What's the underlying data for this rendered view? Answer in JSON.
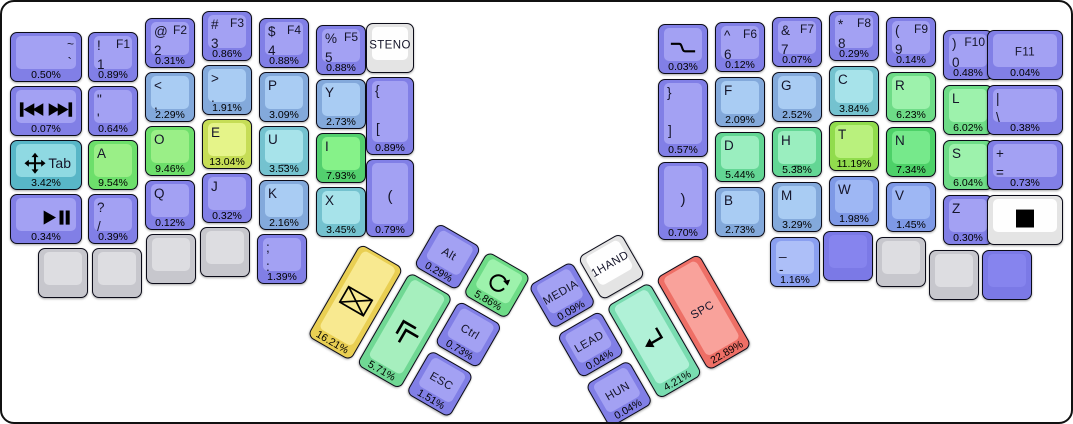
{
  "board": {
    "background": "#ffffff",
    "frame_border": "#111111"
  },
  "colors": {
    "purple": {
      "base": "#817fe6",
      "top": "#a3a1f3"
    },
    "purpleblank": {
      "base": "#7b79e6",
      "top": "#8684ee"
    },
    "lightblue": {
      "base": "#83a9db",
      "top": "#a9ccf3"
    },
    "blue2": {
      "base": "#7e99e6",
      "top": "#9eb7f4"
    },
    "periwinkle": {
      "base": "#8a9ff0",
      "top": "#adbff8"
    },
    "teal": {
      "base": "#58b6c7",
      "top": "#8fd9e2"
    },
    "tealight": {
      "base": "#74c2cf",
      "top": "#a7e3ea"
    },
    "mint": {
      "base": "#63d694",
      "top": "#9aeebf"
    },
    "mint2": {
      "base": "#79dcb0",
      "top": "#b0f1d7"
    },
    "mintgreen": {
      "base": "#70d894",
      "top": "#a6efbe"
    },
    "green": {
      "base": "#6ddf6b",
      "top": "#9aef87"
    },
    "brightgreen": {
      "base": "#53d06e",
      "top": "#86f289"
    },
    "green2": {
      "base": "#6edc87",
      "top": "#9df2ac"
    },
    "greensat": {
      "base": "#4dd168",
      "top": "#76e98b"
    },
    "yellowgreen": {
      "base": "#c6dd56",
      "top": "#e5f489"
    },
    "greenyellow": {
      "base": "#91dc4d",
      "top": "#b9f17d"
    },
    "yellow": {
      "base": "#e9cf53",
      "top": "#f8e990"
    },
    "salmon": {
      "base": "#ee6f66",
      "top": "#f9a29b"
    },
    "white": {
      "base": "#e4e4e4",
      "top": "#fefefe"
    },
    "grey": {
      "base": "#c7c7cd",
      "top": "#dddde1"
    }
  },
  "left_main": [
    {
      "name": "key-grave",
      "x": 10,
      "y": 32,
      "w": 72,
      "color": "purple",
      "labels": [
        [
          "~",
          "tr"
        ],
        [
          "`",
          "r2"
        ]
      ],
      "pct": "0.50%"
    },
    {
      "name": "key-1",
      "x": 88,
      "y": 32,
      "color": "purple",
      "labels": [
        [
          "!",
          "tl"
        ],
        [
          "F1",
          "tr"
        ],
        [
          "1",
          "l2"
        ]
      ],
      "pct": "0.89%"
    },
    {
      "name": "key-2",
      "x": 145,
      "y": 18,
      "color": "purple",
      "labels": [
        [
          "@",
          "tl"
        ],
        [
          "F2",
          "tr"
        ],
        [
          "2",
          "l2"
        ]
      ],
      "pct": "0.31%"
    },
    {
      "name": "key-3",
      "x": 202,
      "y": 11,
      "color": "purple",
      "labels": [
        [
          "#",
          "tl"
        ],
        [
          "F3",
          "tr"
        ],
        [
          "3",
          "l2"
        ]
      ],
      "pct": "0.86%"
    },
    {
      "name": "key-4",
      "x": 259,
      "y": 18,
      "color": "purple",
      "labels": [
        [
          "$",
          "tl"
        ],
        [
          "F4",
          "tr"
        ],
        [
          "4",
          "l2"
        ]
      ],
      "pct": "0.88%"
    },
    {
      "name": "key-5",
      "x": 316,
      "y": 25,
      "color": "purple",
      "labels": [
        [
          "%",
          "tl"
        ],
        [
          "F5",
          "tr"
        ],
        [
          "5",
          "l2"
        ]
      ],
      "pct": "0.88%"
    },
    {
      "name": "key-steno",
      "x": 366,
      "y": 23,
      "w": 48,
      "color": "white",
      "labels": [
        [
          "STENO",
          "c"
        ]
      ]
    },
    {
      "name": "key-media-tracks",
      "x": 10,
      "y": 86,
      "w": 72,
      "color": "purple",
      "icon": "prev-next-track-icon",
      "pct": "0.07%"
    },
    {
      "name": "key-quote",
      "x": 88,
      "y": 86,
      "color": "purple",
      "labels": [
        [
          "\"",
          "tl"
        ],
        [
          "'",
          "l2"
        ]
      ],
      "pct": "0.64%"
    },
    {
      "name": "key-comma",
      "x": 145,
      "y": 72,
      "color": "lightblue",
      "labels": [
        [
          "<",
          "tl"
        ],
        [
          ",",
          "l2"
        ]
      ],
      "pct": "2.29%"
    },
    {
      "name": "key-period",
      "x": 202,
      "y": 65,
      "color": "lightblue",
      "labels": [
        [
          ">",
          "tl"
        ],
        [
          ".",
          "l2"
        ]
      ],
      "pct": "1.91%"
    },
    {
      "name": "key-p",
      "x": 259,
      "y": 72,
      "color": "lightblue",
      "labels": [
        [
          "P",
          "tl"
        ]
      ],
      "pct": "3.09%"
    },
    {
      "name": "key-y",
      "x": 316,
      "y": 79,
      "color": "lightblue",
      "labels": [
        [
          "Y",
          "tl"
        ]
      ],
      "pct": "2.73%"
    },
    {
      "name": "key-lbracket",
      "x": 366,
      "y": 77,
      "w": 48,
      "h": 78,
      "color": "purple",
      "labels": [
        [
          "{",
          "tl"
        ],
        [
          "[",
          "l2t"
        ]
      ],
      "pct": "0.89%"
    },
    {
      "name": "key-tab",
      "x": 10,
      "y": 140,
      "w": 72,
      "color": "teal",
      "icon": "move-icon",
      "ipos": "l",
      "labels": [
        [
          "Tab",
          "r"
        ]
      ],
      "pct": "3.42%"
    },
    {
      "name": "key-a",
      "x": 88,
      "y": 140,
      "color": "green",
      "labels": [
        [
          "A",
          "tl"
        ]
      ],
      "pct": "9.54%"
    },
    {
      "name": "key-o",
      "x": 145,
      "y": 126,
      "color": "green",
      "labels": [
        [
          "O",
          "tl"
        ]
      ],
      "pct": "9.46%"
    },
    {
      "name": "key-e",
      "x": 202,
      "y": 119,
      "color": "yellowgreen",
      "labels": [
        [
          "E",
          "tl"
        ]
      ],
      "pct": "13.04%"
    },
    {
      "name": "key-u",
      "x": 259,
      "y": 126,
      "color": "tealight",
      "labels": [
        [
          "U",
          "tl"
        ],
        [
          "_",
          "sub"
        ]
      ],
      "pct": "3.53%"
    },
    {
      "name": "key-i",
      "x": 316,
      "y": 133,
      "color": "brightgreen",
      "labels": [
        [
          "I",
          "tl"
        ]
      ],
      "pct": "7.93%"
    },
    {
      "name": "key-lparen",
      "x": 366,
      "y": 159,
      "w": 48,
      "h": 78,
      "color": "purple",
      "labels": [
        [
          "(",
          "cb"
        ]
      ],
      "pct": "0.79%"
    },
    {
      "name": "key-play-pause",
      "x": 10,
      "y": 194,
      "w": 72,
      "color": "purple",
      "icon": "play-pause-icon",
      "ipos": "r",
      "pct": "0.34%"
    },
    {
      "name": "key-question",
      "x": 88,
      "y": 194,
      "color": "purple",
      "labels": [
        [
          "?",
          "tl"
        ],
        [
          "/",
          "l2"
        ]
      ],
      "pct": "0.39%"
    },
    {
      "name": "key-q",
      "x": 145,
      "y": 180,
      "color": "purple",
      "labels": [
        [
          "Q",
          "tl"
        ]
      ],
      "pct": "0.12%"
    },
    {
      "name": "key-j",
      "x": 202,
      "y": 173,
      "color": "purple",
      "labels": [
        [
          "J",
          "tl"
        ]
      ],
      "pct": "0.32%"
    },
    {
      "name": "key-k",
      "x": 259,
      "y": 180,
      "color": "lightblue",
      "labels": [
        [
          "K",
          "tl"
        ]
      ],
      "pct": "2.16%"
    },
    {
      "name": "key-x",
      "x": 316,
      "y": 187,
      "color": "tealight",
      "labels": [
        [
          "X",
          "tl"
        ]
      ],
      "pct": "3.45%"
    },
    {
      "name": "key-blank",
      "x": 38,
      "y": 248,
      "color": "grey"
    },
    {
      "name": "key-blank",
      "x": 92,
      "y": 248,
      "color": "grey"
    },
    {
      "name": "key-blank",
      "x": 146,
      "y": 234,
      "color": "grey"
    },
    {
      "name": "key-blank",
      "x": 200,
      "y": 227,
      "color": "grey"
    },
    {
      "name": "key-semicolon",
      "x": 257,
      "y": 234,
      "color": "purple",
      "labels": [
        [
          ";",
          "tl"
        ],
        [
          ":",
          "l2"
        ]
      ],
      "pct": "1.39%"
    }
  ],
  "right_main": [
    {
      "name": "key-wave",
      "x": 658,
      "y": 24,
      "color": "purple",
      "icon": "wave-icon",
      "pct": "0.03%"
    },
    {
      "name": "key-6",
      "x": 715,
      "y": 22,
      "color": "purple",
      "labels": [
        [
          "^",
          "tl"
        ],
        [
          "F6",
          "tr"
        ],
        [
          "6",
          "l2"
        ]
      ],
      "pct": "0.12%"
    },
    {
      "name": "key-7",
      "x": 772,
      "y": 17,
      "color": "purple",
      "labels": [
        [
          "&",
          "tl"
        ],
        [
          "F7",
          "tr"
        ],
        [
          "7",
          "l2"
        ]
      ],
      "pct": "0.07%"
    },
    {
      "name": "key-8",
      "x": 829,
      "y": 11,
      "color": "purple",
      "labels": [
        [
          "*",
          "tl"
        ],
        [
          "F8",
          "tr"
        ],
        [
          "8",
          "l2"
        ]
      ],
      "pct": "0.29%"
    },
    {
      "name": "key-9",
      "x": 886,
      "y": 17,
      "color": "purple",
      "labels": [
        [
          "(",
          "tl"
        ],
        [
          "F9",
          "tr"
        ],
        [
          "9",
          "l2"
        ]
      ],
      "pct": "0.14%"
    },
    {
      "name": "key-0",
      "x": 943,
      "y": 30,
      "color": "purple",
      "labels": [
        [
          ")",
          "tl"
        ],
        [
          "F10",
          "tr"
        ],
        [
          "0",
          "l2"
        ]
      ],
      "pct": "0.48%"
    },
    {
      "name": "key-f11",
      "x": 987,
      "y": 30,
      "w": 76,
      "color": "purple",
      "labels": [
        [
          "F11",
          "c"
        ]
      ],
      "pct": "0.04%"
    },
    {
      "name": "key-rbracket",
      "x": 658,
      "y": 79,
      "h": 78,
      "color": "purple",
      "labels": [
        [
          "}",
          "tl"
        ],
        [
          "]",
          "l2t"
        ]
      ],
      "pct": "0.57%"
    },
    {
      "name": "key-f",
      "x": 715,
      "y": 77,
      "color": "lightblue",
      "labels": [
        [
          "F",
          "tl"
        ]
      ],
      "pct": "2.09%"
    },
    {
      "name": "key-g",
      "x": 772,
      "y": 72,
      "color": "lightblue",
      "labels": [
        [
          "G",
          "tl"
        ]
      ],
      "pct": "2.52%"
    },
    {
      "name": "key-c",
      "x": 829,
      "y": 66,
      "color": "tealight",
      "labels": [
        [
          "C",
          "tl"
        ]
      ],
      "pct": "3.84%"
    },
    {
      "name": "key-r",
      "x": 886,
      "y": 72,
      "color": "green2",
      "labels": [
        [
          "R",
          "tl"
        ]
      ],
      "pct": "6.23%"
    },
    {
      "name": "key-l",
      "x": 943,
      "y": 85,
      "color": "green2",
      "labels": [
        [
          "L",
          "tl"
        ]
      ],
      "pct": "6.02%"
    },
    {
      "name": "key-pipe",
      "x": 987,
      "y": 85,
      "w": 76,
      "color": "purple",
      "labels": [
        [
          "|",
          "tl"
        ],
        [
          "\\",
          "l2"
        ]
      ],
      "pct": "0.38%"
    },
    {
      "name": "key-rparen",
      "x": 658,
      "y": 162,
      "h": 78,
      "color": "purple",
      "labels": [
        [
          ")",
          "cb"
        ]
      ],
      "pct": "0.70%"
    },
    {
      "name": "key-d",
      "x": 715,
      "y": 132,
      "color": "mint",
      "labels": [
        [
          "D",
          "tl"
        ]
      ],
      "pct": "5.44%"
    },
    {
      "name": "key-h",
      "x": 772,
      "y": 127,
      "color": "mint",
      "labels": [
        [
          "H",
          "tl"
        ],
        [
          "_",
          "sub"
        ]
      ],
      "pct": "5.38%"
    },
    {
      "name": "key-t",
      "x": 829,
      "y": 121,
      "color": "greenyellow",
      "labels": [
        [
          "T",
          "tl"
        ]
      ],
      "pct": "11.19%"
    },
    {
      "name": "key-n",
      "x": 886,
      "y": 127,
      "color": "greensat",
      "labels": [
        [
          "N",
          "tl"
        ]
      ],
      "pct": "7.34%"
    },
    {
      "name": "key-s",
      "x": 943,
      "y": 140,
      "color": "green2",
      "labels": [
        [
          "S",
          "tl"
        ]
      ],
      "pct": "6.04%"
    },
    {
      "name": "key-plus",
      "x": 987,
      "y": 140,
      "w": 76,
      "color": "purple",
      "labels": [
        [
          "+",
          "tl"
        ],
        [
          "=",
          "l2"
        ]
      ],
      "pct": "0.73%"
    },
    {
      "name": "key-b",
      "x": 715,
      "y": 187,
      "color": "lightblue",
      "labels": [
        [
          "B",
          "tl"
        ]
      ],
      "pct": "2.73%"
    },
    {
      "name": "key-m",
      "x": 772,
      "y": 182,
      "color": "lightblue",
      "labels": [
        [
          "M",
          "tl"
        ]
      ],
      "pct": "3.29%"
    },
    {
      "name": "key-w",
      "x": 829,
      "y": 176,
      "color": "blue2",
      "labels": [
        [
          "W",
          "tl"
        ]
      ],
      "pct": "1.98%"
    },
    {
      "name": "key-v",
      "x": 886,
      "y": 182,
      "color": "blue2",
      "labels": [
        [
          "V",
          "tl"
        ]
      ],
      "pct": "1.45%"
    },
    {
      "name": "key-z",
      "x": 943,
      "y": 195,
      "color": "purple",
      "labels": [
        [
          "Z",
          "tl"
        ]
      ],
      "pct": "0.30%"
    },
    {
      "name": "key-black-square",
      "x": 987,
      "y": 195,
      "w": 76,
      "color": "white",
      "icon": "black-square-icon"
    },
    {
      "name": "key-minus",
      "x": 770,
      "y": 237,
      "color": "periwinkle",
      "labels": [
        [
          "_",
          "tl"
        ],
        [
          "-",
          "l2"
        ]
      ],
      "pct": "1.16%"
    },
    {
      "name": "key-blank",
      "x": 823,
      "y": 231,
      "color": "purpleblank"
    },
    {
      "name": "key-blank",
      "x": 876,
      "y": 237,
      "color": "grey"
    },
    {
      "name": "key-blank",
      "x": 929,
      "y": 250,
      "color": "grey"
    },
    {
      "name": "key-blank",
      "x": 982,
      "y": 250,
      "color": "purpleblank"
    }
  ],
  "left_thumb": {
    "name": "left-thumb-cluster",
    "angle": 30,
    "x": 389,
    "y": 194,
    "keys": [
      {
        "name": "key-alt",
        "x": 57,
        "y": 0,
        "color": "purple",
        "labels": [
          [
            "Alt",
            "c"
          ]
        ],
        "pct": "0.29%"
      },
      {
        "name": "key-rotate",
        "x": 114,
        "y": 0,
        "color": "green2",
        "icon": "rotate-icon",
        "pct": "5.86%"
      },
      {
        "name": "key-mail",
        "x": 0,
        "y": 57,
        "h": 107,
        "color": "yellow",
        "icon": "envelope-icon",
        "pct": "16.21%"
      },
      {
        "name": "key-shift",
        "x": 57,
        "y": 57,
        "h": 107,
        "color": "mintgreen",
        "icon": "shift-chevrons-icon",
        "pct": "5.71%"
      },
      {
        "name": "key-ctrl",
        "x": 114,
        "y": 57,
        "color": "purple",
        "labels": [
          [
            "Ctrl",
            "c"
          ]
        ],
        "pct": "0.73%"
      },
      {
        "name": "key-esc",
        "x": 114,
        "y": 114,
        "color": "purple",
        "labels": [
          [
            "ESC",
            "c"
          ]
        ],
        "pct": "1.51%"
      }
    ]
  },
  "right_thumb": {
    "name": "right-thumb-cluster",
    "angle": -30,
    "x": 528,
    "y": 286,
    "keys": [
      {
        "name": "key-media-layer",
        "x": 0,
        "y": 0,
        "color": "purple",
        "labels": [
          [
            "MEDIA",
            "c"
          ]
        ],
        "pct": "0.09%"
      },
      {
        "name": "key-onehand",
        "x": 57,
        "y": 0,
        "color": "white",
        "labels": [
          [
            "1HAND",
            "c"
          ]
        ]
      },
      {
        "name": "key-lead",
        "x": 0,
        "y": 57,
        "color": "purple",
        "labels": [
          [
            "LEAD",
            "c"
          ]
        ],
        "pct": "0.04%"
      },
      {
        "name": "key-enter",
        "x": 57,
        "y": 57,
        "h": 107,
        "color": "mint2",
        "icon": "enter-icon",
        "pct": "4.21%"
      },
      {
        "name": "key-space",
        "x": 114,
        "y": 57,
        "h": 107,
        "color": "salmon",
        "labels": [
          [
            "SPC",
            "c"
          ]
        ],
        "pct": "22.89%"
      },
      {
        "name": "key-hun",
        "x": 0,
        "y": 114,
        "color": "purple",
        "labels": [
          [
            "HUN",
            "c"
          ]
        ],
        "pct": "0.04%"
      }
    ]
  }
}
